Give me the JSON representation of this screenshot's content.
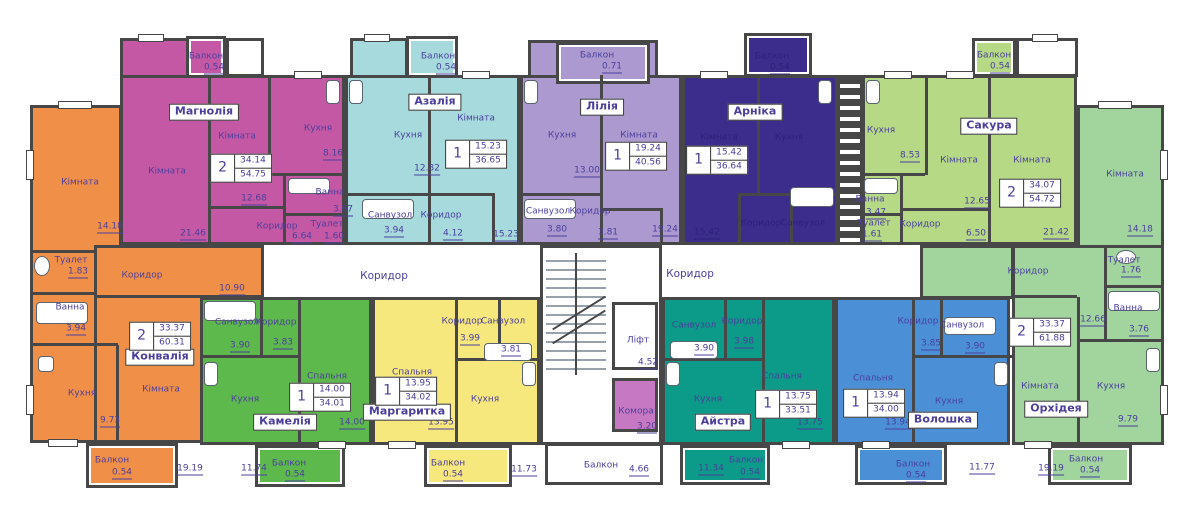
{
  "corridors": {
    "left": {
      "label": "Коридор"
    },
    "right": {
      "label": "Коридор"
    }
  },
  "core": {
    "lift": {
      "label": "Ліфт",
      "area": "4.52"
    },
    "storage": {
      "label": "Комора",
      "area": "3.20",
      "color": "#c678c3"
    },
    "balcony": {
      "label": "Балкон",
      "area": "4.66"
    }
  },
  "apartments": [
    {
      "name": "Конвалія",
      "color": "#f09048",
      "stats": {
        "rooms": "2",
        "living": "33.37",
        "total": "60.31"
      },
      "rooms": [
        {
          "label": "Кімната",
          "area": "14.18"
        },
        {
          "label": "Туалет",
          "area": "1.83"
        },
        {
          "label": "Ванна",
          "area": "3.94"
        },
        {
          "label": "Коридор",
          "area": "10.90"
        },
        {
          "label": "Кухня",
          "area": "9.73"
        },
        {
          "label": "Кімната",
          "area": "19.19"
        },
        {
          "label": "Балкон",
          "area": "0.54"
        }
      ]
    },
    {
      "name": "Магнолія",
      "color": "#c558a4",
      "stats": {
        "rooms": "2",
        "living": "34.14",
        "total": "54.75"
      },
      "rooms": [
        {
          "label": "Кімната",
          "area": "21.46"
        },
        {
          "label": "Кімната",
          "area": "12.68"
        },
        {
          "label": "Кухня",
          "area": "8.16"
        },
        {
          "label": "Ванна",
          "area": "3.67"
        },
        {
          "label": "Туалет",
          "area": "1.60"
        },
        {
          "label": "Коридор",
          "area": "6.64"
        },
        {
          "label": "Балкон",
          "area": "0.54"
        }
      ]
    },
    {
      "name": "Азалія",
      "color": "#a6dadd",
      "stats": {
        "rooms": "1",
        "living": "15.23",
        "total": "36.65"
      },
      "rooms": [
        {
          "label": "Кухня",
          "area": "12.82"
        },
        {
          "label": "Кімната",
          "area": "15.23"
        },
        {
          "label": "Санвузол",
          "area": "3.94"
        },
        {
          "label": "Коридор",
          "area": "4.12"
        },
        {
          "label": "Балкон",
          "area": "0.54"
        }
      ]
    },
    {
      "name": "Лілія",
      "color": "#ac99cf",
      "stats": {
        "rooms": "1",
        "living": "19.24",
        "total": "40.56"
      },
      "rooms": [
        {
          "label": "Кухня",
          "area": "13.00"
        },
        {
          "label": "Кімната",
          "area": "19.24"
        },
        {
          "label": "Санвузол",
          "area": "3.80"
        },
        {
          "label": "Коридор",
          "area": "3.81"
        },
        {
          "label": "Балкон",
          "area": "0.71"
        }
      ]
    },
    {
      "name": "Арніка",
      "color": "#3c2c8c",
      "stats": {
        "rooms": "1",
        "living": "15.42",
        "total": "36.64"
      },
      "rooms": [
        {
          "label": "Кімната",
          "area": "15.42"
        },
        {
          "label": "Кухня",
          "area": ""
        },
        {
          "label": "Коридор",
          "area": ""
        },
        {
          "label": "Санвузол",
          "area": ""
        },
        {
          "label": "Балкон",
          "area": "0.54"
        }
      ]
    },
    {
      "name": "Сакура",
      "color": "#b6d985",
      "stats": {
        "rooms": "2",
        "living": "34.07",
        "total": "54.72"
      },
      "rooms": [
        {
          "label": "Кухня",
          "area": "8.53"
        },
        {
          "label": "Кімната",
          "area": "12.65"
        },
        {
          "label": "Кімната",
          "area": "21.42"
        },
        {
          "label": "Ванна",
          "area": "3.47"
        },
        {
          "label": "Туалет",
          "area": "1.61"
        },
        {
          "label": "Коридор",
          "area": "6.50"
        },
        {
          "label": "Балкон",
          "area": "0.54"
        }
      ]
    },
    {
      "name": "Орхідея",
      "color": "#a2d59e",
      "stats": {
        "rooms": "2",
        "living": "33.37",
        "total": "61.88"
      },
      "rooms": [
        {
          "label": "Кімната",
          "area": "14.18"
        },
        {
          "label": "Коридор",
          "area": "12.66"
        },
        {
          "label": "Туалет",
          "area": "1.76"
        },
        {
          "label": "Ванна",
          "area": "3.76"
        },
        {
          "label": "Кімната",
          "area": "19.19"
        },
        {
          "label": "Кухня",
          "area": "9.79"
        },
        {
          "label": "Балкон",
          "area": "0.54"
        }
      ]
    },
    {
      "name": "Камелія",
      "color": "#5eb94d",
      "stats": {
        "rooms": "1",
        "living": "14.00",
        "total": "34.01"
      },
      "rooms": [
        {
          "label": "Санвузол",
          "area": "3.90"
        },
        {
          "label": "Коридор",
          "area": "3.83"
        },
        {
          "label": "Спальня",
          "area": "14.00"
        },
        {
          "label": "Кухня",
          "area": "11.74"
        },
        {
          "label": "Балкон",
          "area": "0.54"
        }
      ]
    },
    {
      "name": "Маргаритка",
      "color": "#f6e87c",
      "stats": {
        "rooms": "1",
        "living": "13.95",
        "total": "34.02"
      },
      "rooms": [
        {
          "label": "Коридор",
          "area": "3.99"
        },
        {
          "label": "Санвузол",
          "area": "3.81"
        },
        {
          "label": "Спальня",
          "area": "13.95"
        },
        {
          "label": "Кухня",
          "area": "11.73"
        },
        {
          "label": "Балкон",
          "area": "0.54"
        }
      ]
    },
    {
      "name": "Айстра",
      "color": "#0c9a89",
      "stats": {
        "rooms": "1",
        "living": "13.75",
        "total": "33.51"
      },
      "rooms": [
        {
          "label": "Санвузол",
          "area": "3.90"
        },
        {
          "label": "Коридор",
          "area": "3.98"
        },
        {
          "label": "Спальня",
          "area": "13.75"
        },
        {
          "label": "Кухня",
          "area": "11.34"
        },
        {
          "label": "Балкон",
          "area": "0.54"
        }
      ]
    },
    {
      "name": "Волошка",
      "color": "#4b90d7",
      "stats": {
        "rooms": "1",
        "living": "13.94",
        "total": "34.00"
      },
      "rooms": [
        {
          "label": "Коридор",
          "area": "3.85"
        },
        {
          "label": "Санвузол",
          "area": "3.90"
        },
        {
          "label": "Спальня",
          "area": "13.94"
        },
        {
          "label": "Кухня",
          "area": "11.77"
        },
        {
          "label": "Балкон",
          "area": "0.54"
        }
      ]
    }
  ]
}
